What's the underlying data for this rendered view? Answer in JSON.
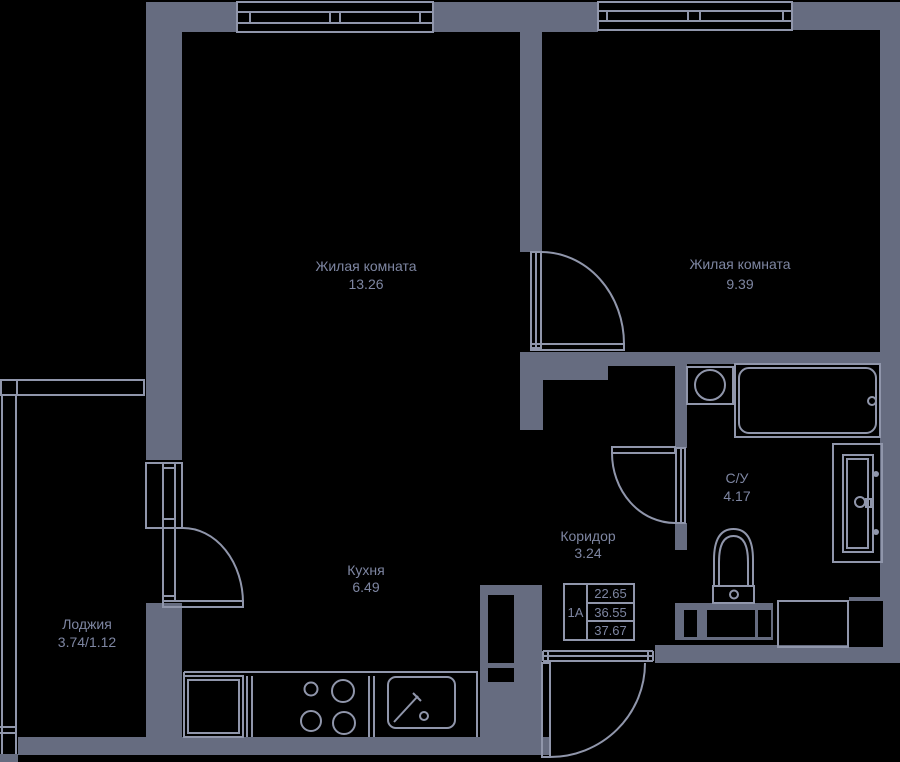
{
  "colors": {
    "background": "#000000",
    "wall": "#666C80",
    "line": "#9096AB",
    "text": "#7E86A2"
  },
  "rooms": {
    "living1": {
      "label": "Жилая комната",
      "area": "13.26"
    },
    "living2": {
      "label": "Жилая комната",
      "area": "9.39"
    },
    "kitchen": {
      "label": "Кухня",
      "area": "6.49"
    },
    "corridor": {
      "label": "Коридор",
      "area": "3.24"
    },
    "bathroom": {
      "label": "С/У",
      "area": "4.17"
    },
    "loggia": {
      "label": "Лоджия",
      "area": "3.74/1.12"
    }
  },
  "info_box": {
    "unit": "1А",
    "living_area": "22.65",
    "area_no_summer": "36.55",
    "total_area": "37.67"
  },
  "icons": {
    "bathtub": "rounded-rect-with-drain",
    "washbasin": "square-with-circle",
    "toilet": "dome-bowl-with-tank",
    "towel-cabinet": "nested-rects-with-handle",
    "washing-machine": "outlined-rect",
    "refrigerator": "double-square",
    "stove": "four-burner-circles",
    "kitchen-sink": "rounded-rect-with-faucet",
    "door": "quarter-arc-leaf",
    "window": "triple-line-band",
    "vent-shaft": "gray-block-with-holes"
  }
}
